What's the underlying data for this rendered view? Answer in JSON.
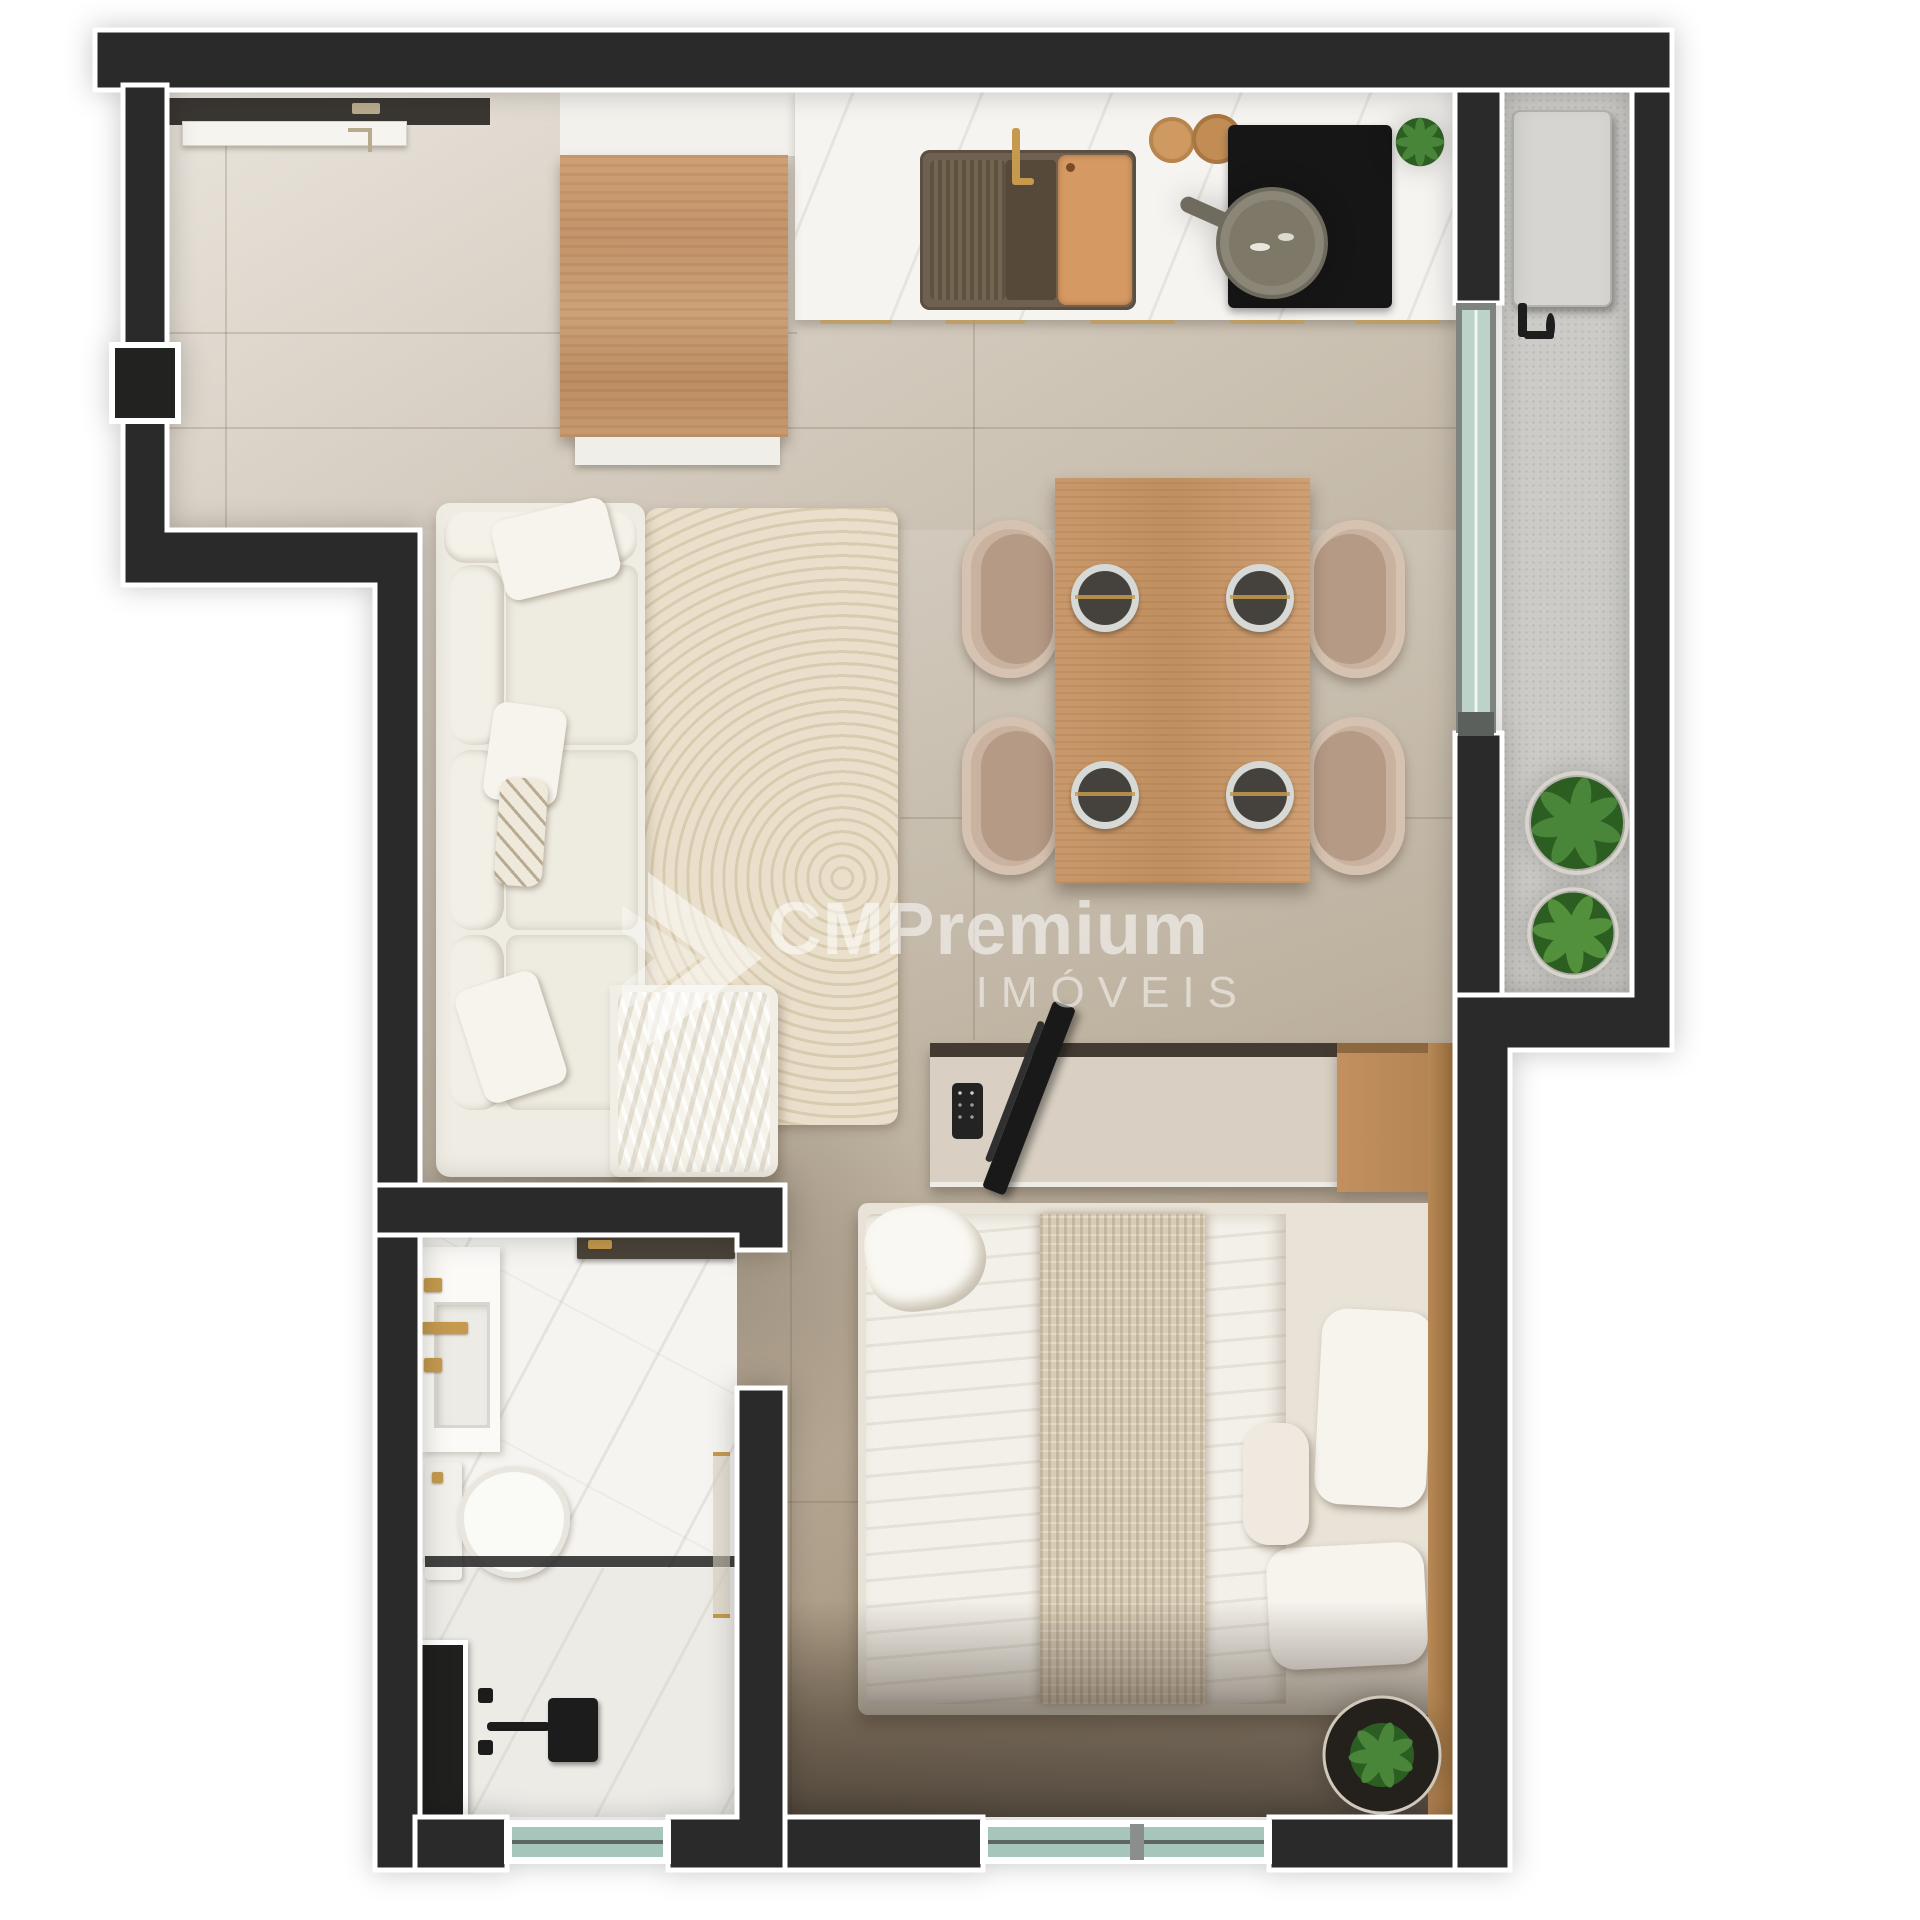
{
  "watermark": {
    "brand": "CMPremium",
    "sub": "IMÓVEIS"
  },
  "colors": {
    "wall": "#2a2a2a",
    "outline": "#ffffff",
    "floor": "#cdc4b6",
    "floor_light": "#e6e1d8",
    "floor_dark": "#a3937e",
    "marble": "#f6f4f0",
    "balcony": "#cccbc7",
    "wood": "#c3946a",
    "wood_dark": "#a97f52",
    "sofa": "#efece3",
    "rug": "#e6dcc8",
    "chair": "#c9b3a0",
    "seat": "#b59a85",
    "glass": "#b7cfc5",
    "plant": "#3c7a31",
    "plant_dark": "#2a571f",
    "gold": "#c59a4e",
    "dark": "#1b1b1b",
    "console": "#d9d0c3",
    "bed": "#f3f0e9",
    "throw": "#d9ccb5"
  }
}
